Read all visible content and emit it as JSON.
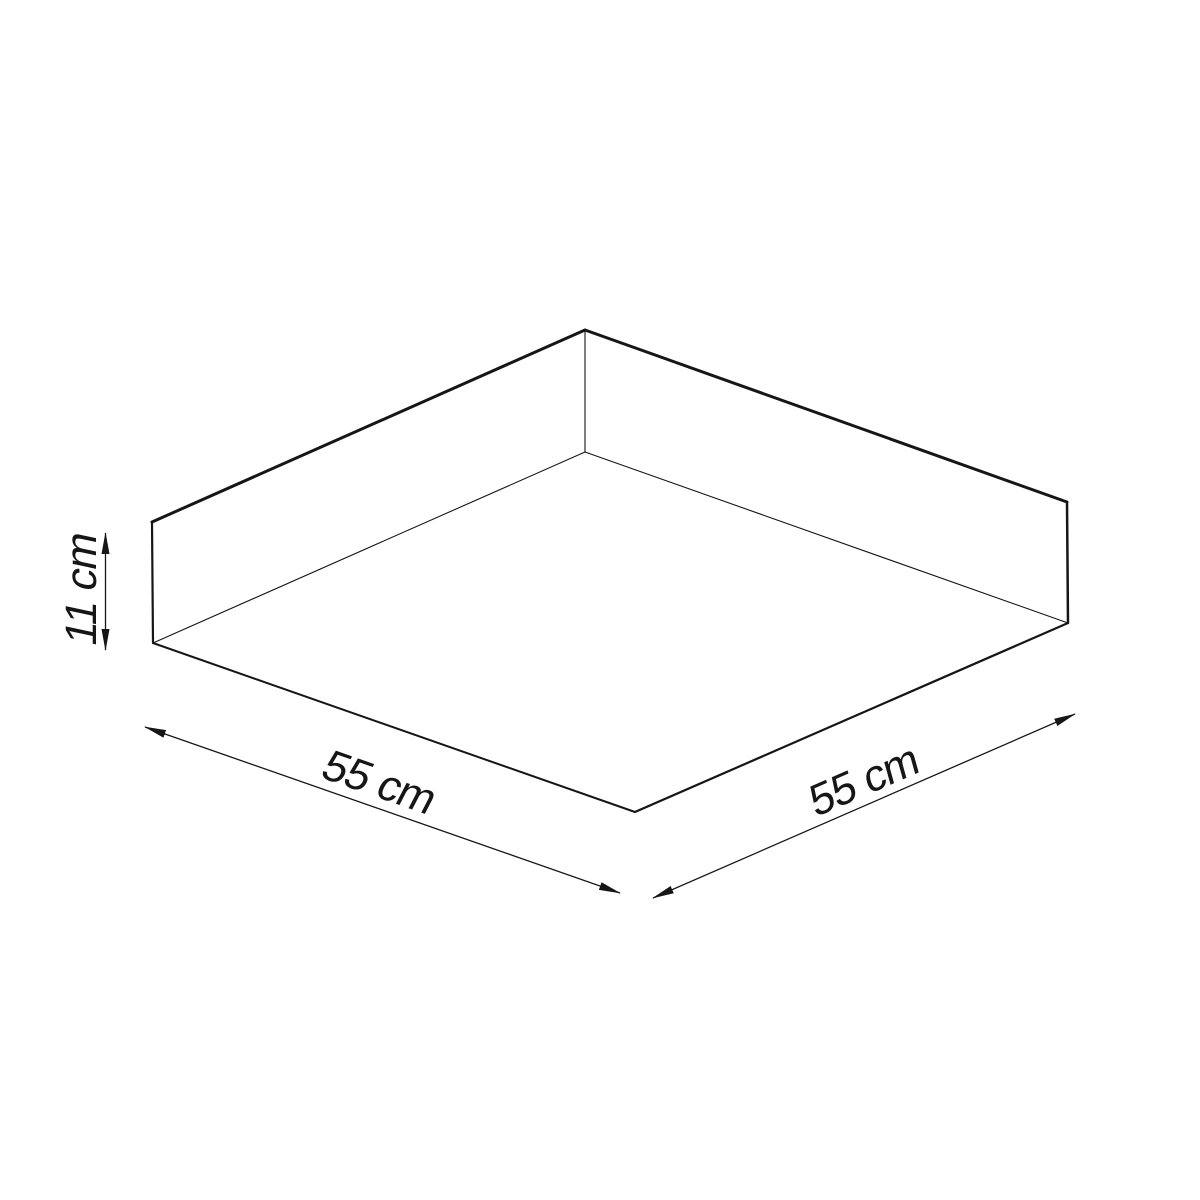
{
  "canvas": {
    "width": 1200,
    "height": 1200,
    "background": "#ffffff",
    "line_color": "#161616"
  },
  "diagram": {
    "type": "isometric dimension line drawing",
    "subject": "square ceiling lamp shade",
    "box": {
      "vertices": {
        "apex_top": [
          585,
          330
        ],
        "left_top": [
          152,
          522
        ],
        "right_top": [
          1067,
          502
        ],
        "left_bottom": [
          153,
          643
        ],
        "right_bottom": [
          1068,
          623
        ],
        "front_bottom": [
          635,
          812
        ],
        "apex_inner": [
          585,
          452
        ]
      },
      "edges": [
        {
          "from": "left_top",
          "to": "apex_top",
          "width": 3
        },
        {
          "from": "apex_top",
          "to": "right_top",
          "width": 3
        },
        {
          "from": "left_top",
          "to": "left_bottom",
          "width": 2.2
        },
        {
          "from": "right_top",
          "to": "right_bottom",
          "width": 2.5
        },
        {
          "from": "left_bottom",
          "to": "front_bottom",
          "width": 2
        },
        {
          "from": "front_bottom",
          "to": "right_bottom",
          "width": 2.2
        },
        {
          "from": "apex_top",
          "to": "apex_inner",
          "width": 1.1
        },
        {
          "from": "apex_inner",
          "to": "left_bottom",
          "width": 1.1
        },
        {
          "from": "apex_inner",
          "to": "right_bottom",
          "width": 1.1
        }
      ]
    },
    "dimensions": [
      {
        "label": "11 cm",
        "measures": "height",
        "line": [
          [
            105.5,
            533
          ],
          [
            105.5,
            650
          ]
        ],
        "arrows": "both",
        "label_center": [
          82,
          589
        ],
        "label_angle_deg": -90,
        "label_skew_deg": -12
      },
      {
        "label": "55 cm",
        "measures": "width",
        "line": [
          [
            145,
            727
          ],
          [
            620,
            893
          ]
        ],
        "arrows": "both",
        "label_center": [
          379,
          783
        ],
        "label_angle_deg": 19.3,
        "label_skew_deg": -8
      },
      {
        "label": "55 cm",
        "measures": "depth",
        "line": [
          [
            653,
            898
          ],
          [
            1075,
            714
          ]
        ],
        "arrows": "both",
        "label_center": [
          864,
          781
        ],
        "label_angle_deg": -23.5,
        "label_skew_deg": -8
      }
    ]
  }
}
